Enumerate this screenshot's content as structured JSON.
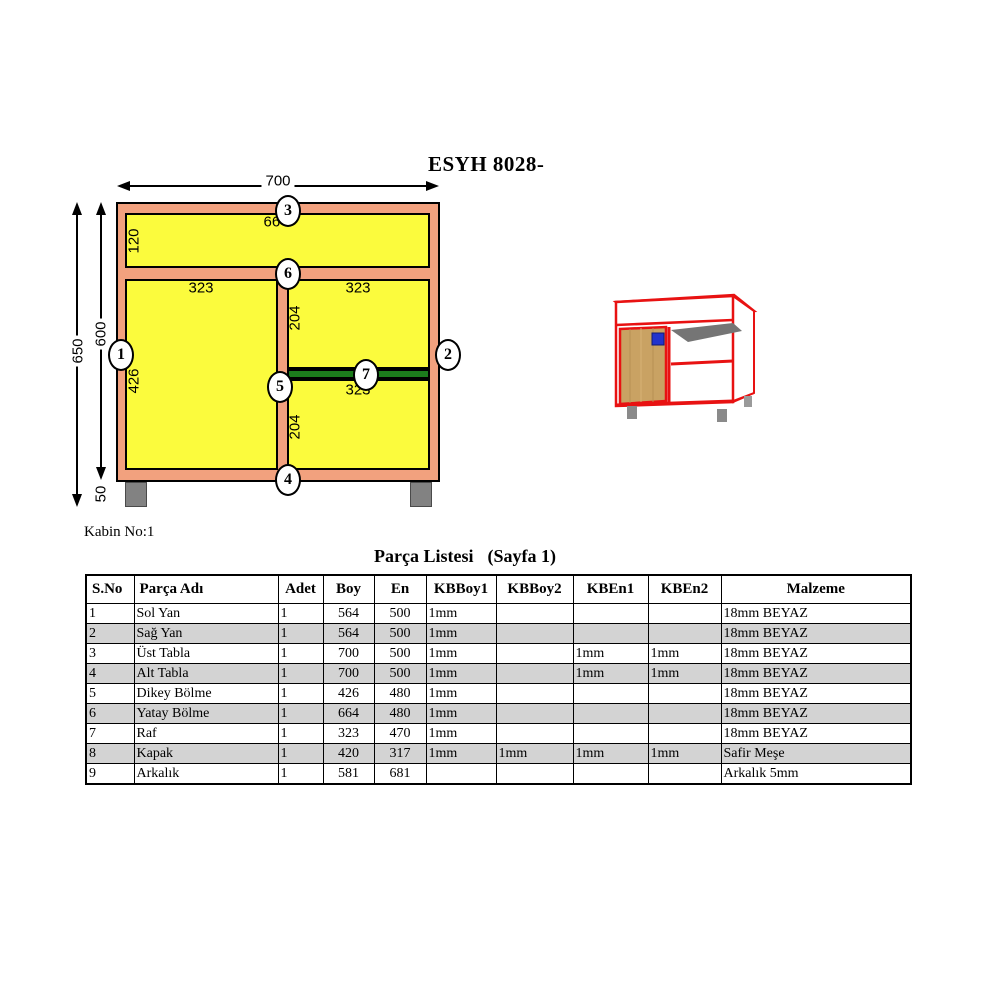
{
  "header": {
    "title": "ESYH 8028-"
  },
  "drawing": {
    "labels": {
      "width_700": "700",
      "inner_664": "664",
      "height_650": "650",
      "height_600": "600",
      "section_120": "120",
      "section_426": "426",
      "legs_50": "50",
      "shelf_left_323": "323",
      "shelf_right_323": "323",
      "gap_upper_204": "204",
      "gap_lower_204": "204",
      "raf_323": "323"
    },
    "markers": [
      "1",
      "2",
      "3",
      "4",
      "5",
      "6",
      "7"
    ],
    "colors": {
      "panel_yellow": "#FBFB3D",
      "frame_salmon": "#F2A17E",
      "shelf_green": "#1C7C1C",
      "leg_gray": "#828282",
      "row_shade": "#D3D3D3",
      "preview_red": "#E81212",
      "preview_wood": "#C9A263",
      "preview_handle": "#2233CC",
      "preview_gray": "#757575"
    }
  },
  "cabin_note": "Kabin No:1",
  "table": {
    "title": "Parça Listesi",
    "page": "(Sayfa 1)",
    "columns": [
      "S.No",
      "Parça Adı",
      "Adet",
      "Boy",
      "En",
      "KBBoy1",
      "KBBoy2",
      "KBEn1",
      "KBEn2",
      "Malzeme"
    ],
    "rows": [
      {
        "no": "1",
        "name": "Sol Yan",
        "adet": "1",
        "boy": "564",
        "en": "500",
        "kbboy1": "1mm",
        "kbboy2": "",
        "kben1": "",
        "kben2": "",
        "malzeme": "18mm BEYAZ",
        "shaded": false
      },
      {
        "no": "2",
        "name": "Sağ Yan",
        "adet": "1",
        "boy": "564",
        "en": "500",
        "kbboy1": "1mm",
        "kbboy2": "",
        "kben1": "",
        "kben2": "",
        "malzeme": "18mm BEYAZ",
        "shaded": true
      },
      {
        "no": "3",
        "name": "Üst Tabla",
        "adet": "1",
        "boy": "700",
        "en": "500",
        "kbboy1": "1mm",
        "kbboy2": "",
        "kben1": "1mm",
        "kben2": "1mm",
        "malzeme": "18mm BEYAZ",
        "shaded": false
      },
      {
        "no": "4",
        "name": "Alt Tabla",
        "adet": "1",
        "boy": "700",
        "en": "500",
        "kbboy1": "1mm",
        "kbboy2": "",
        "kben1": "1mm",
        "kben2": "1mm",
        "malzeme": "18mm BEYAZ",
        "shaded": true
      },
      {
        "no": "5",
        "name": "Dikey Bölme",
        "adet": "1",
        "boy": "426",
        "en": "480",
        "kbboy1": "1mm",
        "kbboy2": "",
        "kben1": "",
        "kben2": "",
        "malzeme": "18mm BEYAZ",
        "shaded": false
      },
      {
        "no": "6",
        "name": "Yatay Bölme",
        "adet": "1",
        "boy": "664",
        "en": "480",
        "kbboy1": "1mm",
        "kbboy2": "",
        "kben1": "",
        "kben2": "",
        "malzeme": "18mm BEYAZ",
        "shaded": true
      },
      {
        "no": "7",
        "name": "Raf",
        "adet": "1",
        "boy": "323",
        "en": "470",
        "kbboy1": "1mm",
        "kbboy2": "",
        "kben1": "",
        "kben2": "",
        "malzeme": "18mm BEYAZ",
        "shaded": false
      },
      {
        "no": "8",
        "name": "Kapak",
        "adet": "1",
        "boy": "420",
        "en": "317",
        "kbboy1": "1mm",
        "kbboy2": "1mm",
        "kben1": "1mm",
        "kben2": "1mm",
        "malzeme": "Safir Meşe",
        "shaded": true
      },
      {
        "no": "9",
        "name": "Arkalık",
        "adet": "1",
        "boy": "581",
        "en": "681",
        "kbboy1": "",
        "kbboy2": "",
        "kben1": "",
        "kben2": "",
        "malzeme": "Arkalık 5mm",
        "shaded": false
      }
    ]
  }
}
